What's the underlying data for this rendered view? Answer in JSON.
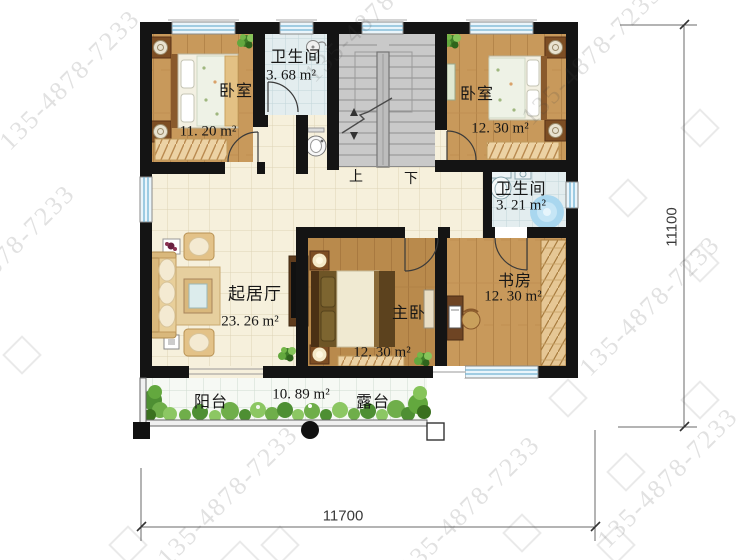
{
  "watermark": {
    "text": "135-4878-7233"
  },
  "dimensions": {
    "width_label": "11700",
    "height_label": "11100"
  },
  "stairs": {
    "up": "上",
    "down": "下"
  },
  "rooms": {
    "bedroom1": {
      "name": "卧室",
      "area": "11. 20 m²"
    },
    "bathroom1": {
      "name": "卫生间",
      "area": "3. 68 m²"
    },
    "bedroom2": {
      "name": "卧室",
      "area": "12. 30 m²"
    },
    "bathroom2": {
      "name": "卫生间",
      "area": "3. 21 m²"
    },
    "study": {
      "name": "书房",
      "area": "12. 30 m²"
    },
    "living": {
      "name": "起居厅",
      "area": "23. 26 m²"
    },
    "master": {
      "name": "主卧",
      "area": "12. 30 m²"
    },
    "balcony": {
      "name": "阳台",
      "area": "10. 89 m²"
    },
    "terrace": {
      "name": "露台"
    }
  },
  "colors": {
    "wall": "#141414",
    "wood_floor": "#c8995b",
    "tile_floor": "#f6f0dc",
    "bath_tile": "#e3edef",
    "window_blue": "#74b4d4",
    "greenery": "#63a83e",
    "watermark_gray": "#bdbdbd"
  }
}
